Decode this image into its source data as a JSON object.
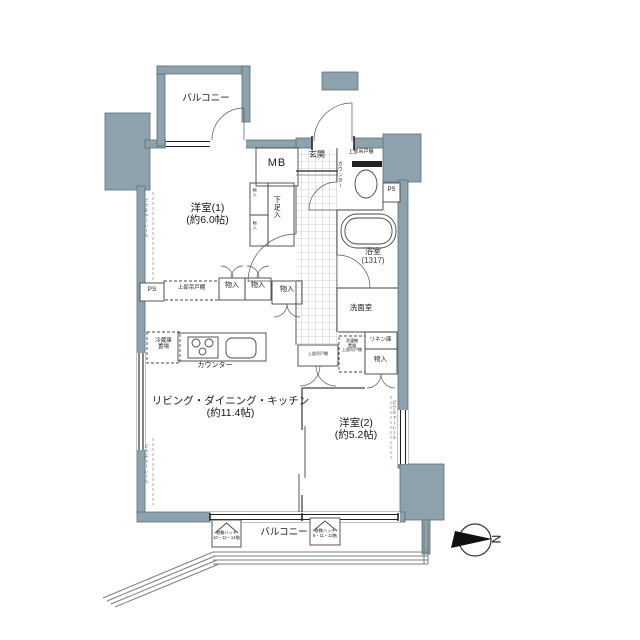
{
  "colors": {
    "wall": "#8da2ad",
    "line": "#444444",
    "bg": "#ffffff",
    "fixture_dark": "#222222"
  },
  "rooms": {
    "balcony_top": {
      "name": "バルコニー"
    },
    "entrance": {
      "name": "玄関"
    },
    "room1": {
      "name": "洋室(1)",
      "size": "(約6.0帖)"
    },
    "bath": {
      "name": "浴室",
      "size": "(1317)"
    },
    "washroom": {
      "name": "洗面室"
    },
    "ldk": {
      "name": "リビング・ダイニング・キッチン",
      "size": "(約11.4帖)"
    },
    "room2": {
      "name": "洋室(2)",
      "size": "(約5.2帖)"
    },
    "balcony_bottom": {
      "name": "バルコニー"
    }
  },
  "fixtures": {
    "mb": "MB",
    "ps": "PS",
    "shoe_box": "下足入",
    "closet_small": "物入",
    "storage": "物入",
    "upper_cabinet": "上部吊戸棚",
    "toilet_counter": "カウンター",
    "kitchen_counter": "カウンター",
    "fridge_line1": "冷蔵庫",
    "fridge_line2": "置場",
    "washer_line1": "洗濯機",
    "washer_line2": "置場",
    "washer_line3": "上部吊戸棚",
    "linen": "リネン庫",
    "picture_rail": "ピクチャーレール"
  },
  "balcony": {
    "escape_hatch": "避難ハッチ",
    "hatch_floors_a": "10・12・14階",
    "hatch_floors_b": "9・11・13階"
  },
  "compass": {
    "letter": "N"
  }
}
